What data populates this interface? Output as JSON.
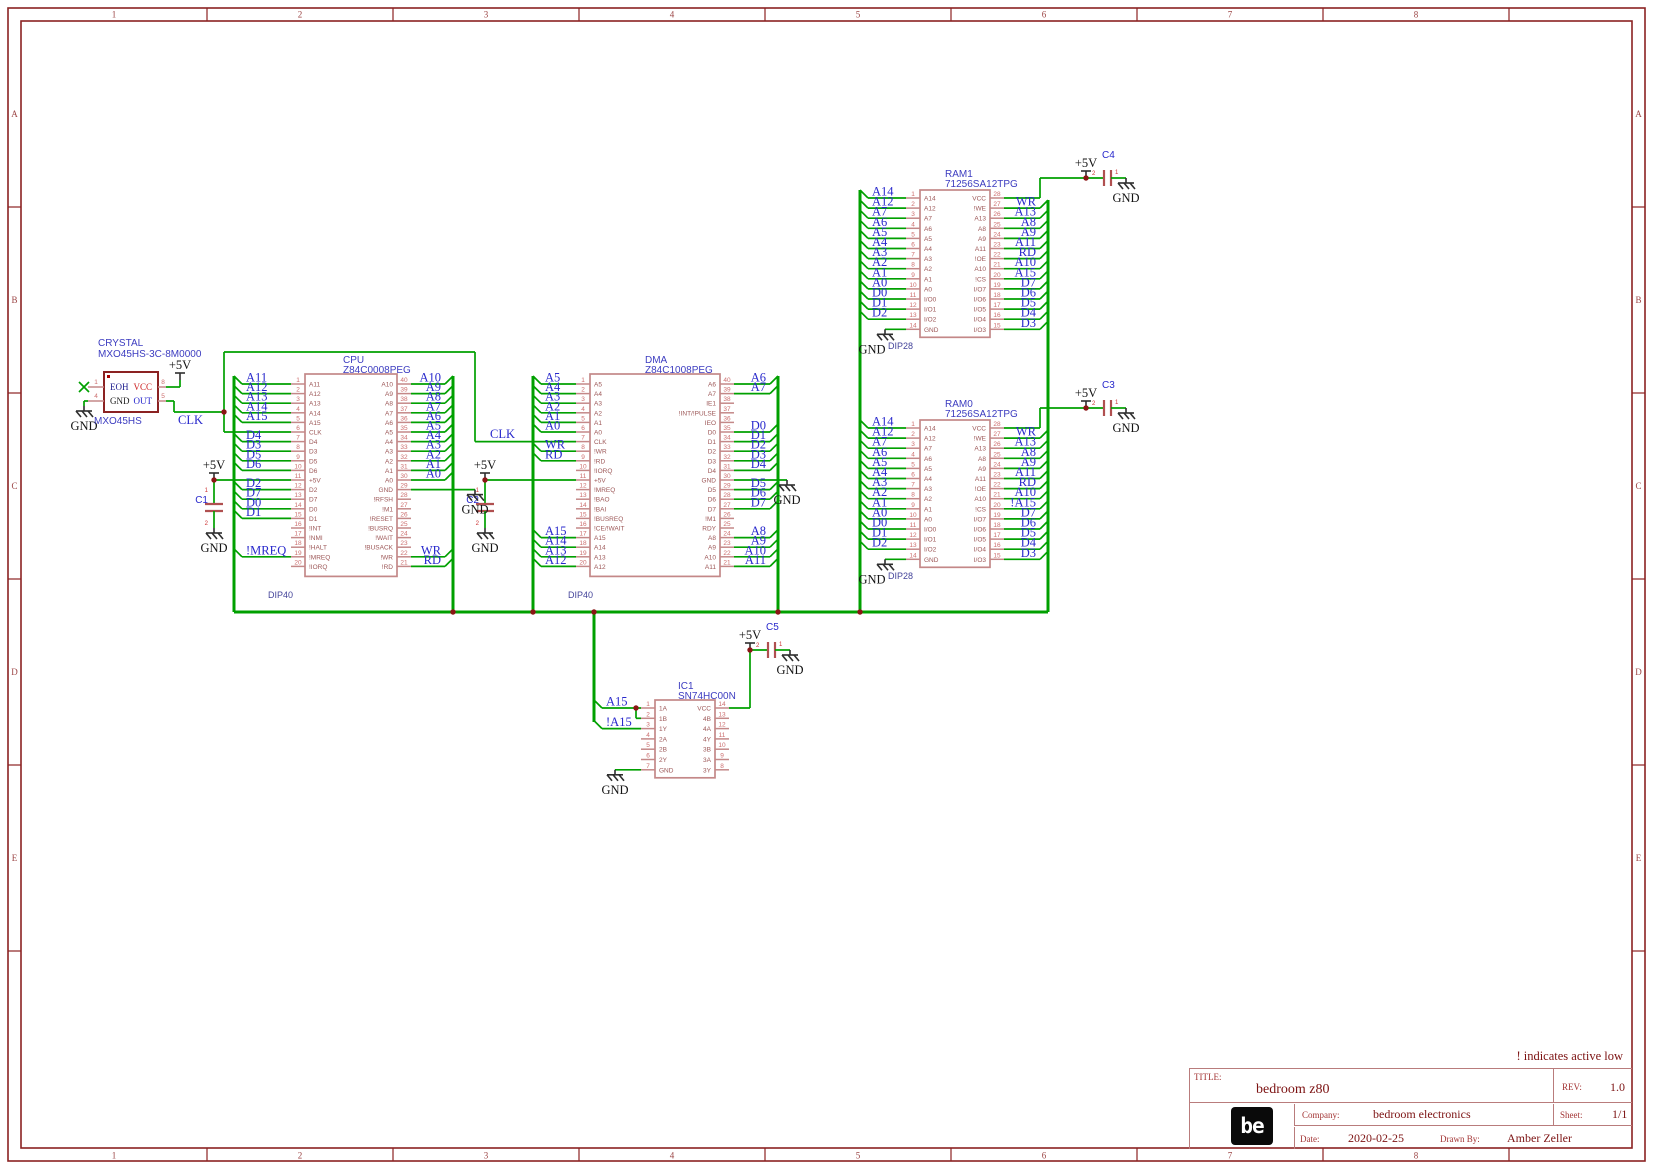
{
  "frame": {
    "columns": [
      "1",
      "2",
      "3",
      "4",
      "5",
      "6",
      "7",
      "8"
    ],
    "rows": [
      "A",
      "B",
      "C",
      "D",
      "E"
    ]
  },
  "note": "! indicates active low",
  "title_block": {
    "title_label": "TITLE:",
    "title": "bedroom z80",
    "rev_label": "REV:",
    "rev": "1.0",
    "company_label": "Company:",
    "company": "bedroom electronics",
    "sheet_label": "Sheet:",
    "sheet": "1/1",
    "date_label": "Date:",
    "date": "2020-02-25",
    "drawn_by_label": "Drawn By:",
    "drawn_by": "Amber Zeller",
    "logo": "be"
  },
  "power": {
    "v5": "+5V",
    "gnd": "GND",
    "clk": "CLK"
  },
  "crystal": {
    "title": "CRYSTAL",
    "part": "MXO45HS-3C-8M0000",
    "footprint": "MXO45HS",
    "pins": {
      "p1": {
        "num": "1",
        "name": "EOH"
      },
      "p4": {
        "num": "4",
        "name": "GND"
      },
      "p5": {
        "num": "5",
        "name": "OUT"
      },
      "p8": {
        "num": "8",
        "name": "VCC"
      }
    }
  },
  "capacitors": [
    {
      "ref": "C1"
    },
    {
      "ref": "C2"
    },
    {
      "ref": "C3"
    },
    {
      "ref": "C4"
    },
    {
      "ref": "C5"
    }
  ],
  "cap_pins": {
    "a": "1",
    "b": "2"
  },
  "chips": [
    {
      "id": "cpu",
      "ref": "CPU",
      "part": "Z84C0008PEG",
      "footprint": "DIP40",
      "left": [
        {
          "num": 1,
          "name": "A11",
          "net": "A11"
        },
        {
          "num": 2,
          "name": "A12",
          "net": "A12"
        },
        {
          "num": 3,
          "name": "A13",
          "net": "A13"
        },
        {
          "num": 4,
          "name": "A14",
          "net": "A14"
        },
        {
          "num": 5,
          "name": "A15",
          "net": "A15"
        },
        {
          "num": 6,
          "name": "CLK",
          "conn": "clk"
        },
        {
          "num": 7,
          "name": "D4",
          "net": "D4"
        },
        {
          "num": 8,
          "name": "D3",
          "net": "D3"
        },
        {
          "num": 9,
          "name": "D5",
          "net": "D5"
        },
        {
          "num": 10,
          "name": "D6",
          "net": "D6"
        },
        {
          "num": 11,
          "name": "+5V",
          "conn": "v5"
        },
        {
          "num": 12,
          "name": "D2",
          "net": "D2"
        },
        {
          "num": 13,
          "name": "D7",
          "net": "D7"
        },
        {
          "num": 14,
          "name": "D0",
          "net": "D0"
        },
        {
          "num": 15,
          "name": "D1",
          "net": "D1"
        },
        {
          "num": 16,
          "name": "!INT"
        },
        {
          "num": 17,
          "name": "!NMI"
        },
        {
          "num": 18,
          "name": "!HALT"
        },
        {
          "num": 19,
          "name": "!MREQ",
          "net": "!MREQ"
        },
        {
          "num": 20,
          "name": "!IORQ"
        }
      ],
      "right": [
        {
          "num": 40,
          "name": "A10",
          "net": "A10"
        },
        {
          "num": 39,
          "name": "A9",
          "net": "A9"
        },
        {
          "num": 38,
          "name": "A8",
          "net": "A8"
        },
        {
          "num": 37,
          "name": "A7",
          "net": "A7"
        },
        {
          "num": 36,
          "name": "A6",
          "net": "A6"
        },
        {
          "num": 35,
          "name": "A5",
          "net": "A5"
        },
        {
          "num": 34,
          "name": "A4",
          "net": "A4"
        },
        {
          "num": 33,
          "name": "A3",
          "net": "A3"
        },
        {
          "num": 32,
          "name": "A2",
          "net": "A2"
        },
        {
          "num": 31,
          "name": "A1",
          "net": "A1"
        },
        {
          "num": 30,
          "name": "A0",
          "net": "A0"
        },
        {
          "num": 29,
          "name": "GND",
          "conn": "gnd"
        },
        {
          "num": 28,
          "name": "!RFSH"
        },
        {
          "num": 27,
          "name": "!M1"
        },
        {
          "num": 26,
          "name": "!RESET"
        },
        {
          "num": 25,
          "name": "!BUSRQ"
        },
        {
          "num": 24,
          "name": "!WAIT"
        },
        {
          "num": 23,
          "name": "!BUSACK"
        },
        {
          "num": 22,
          "name": "!WR",
          "net": "WR"
        },
        {
          "num": 21,
          "name": "!RD",
          "net": "RD"
        }
      ]
    },
    {
      "id": "dma",
      "ref": "DMA",
      "part": "Z84C1008PEG",
      "footprint": "DIP40",
      "left": [
        {
          "num": 1,
          "name": "A5",
          "net": "A5"
        },
        {
          "num": 2,
          "name": "A4",
          "net": "A4"
        },
        {
          "num": 3,
          "name": "A3",
          "net": "A3"
        },
        {
          "num": 4,
          "name": "A2",
          "net": "A2"
        },
        {
          "num": 5,
          "name": "A1",
          "net": "A1"
        },
        {
          "num": 6,
          "name": "A0",
          "net": "A0"
        },
        {
          "num": 7,
          "name": "CLK",
          "conn": "clk"
        },
        {
          "num": 8,
          "name": "!WR",
          "net": "WR"
        },
        {
          "num": 9,
          "name": "!RD",
          "net": "RD"
        },
        {
          "num": 10,
          "name": "!IORQ"
        },
        {
          "num": 11,
          "name": "+5V",
          "conn": "v5"
        },
        {
          "num": 12,
          "name": "!MREQ"
        },
        {
          "num": 13,
          "name": "!BAO"
        },
        {
          "num": 14,
          "name": "!BAI"
        },
        {
          "num": 15,
          "name": "!BUSREQ"
        },
        {
          "num": 16,
          "name": "!CE/!WAIT"
        },
        {
          "num": 17,
          "name": "A15",
          "net": "A15"
        },
        {
          "num": 18,
          "name": "A14",
          "net": "A14"
        },
        {
          "num": 19,
          "name": "A13",
          "net": "A13"
        },
        {
          "num": 20,
          "name": "A12",
          "net": "A12"
        }
      ],
      "right": [
        {
          "num": 40,
          "name": "A6",
          "net": "A6"
        },
        {
          "num": 39,
          "name": "A7",
          "net": "A7"
        },
        {
          "num": 38,
          "name": "IE1"
        },
        {
          "num": 37,
          "name": "!INT/!PULSE"
        },
        {
          "num": 36,
          "name": "IEO"
        },
        {
          "num": 35,
          "name": "D0",
          "net": "D0"
        },
        {
          "num": 34,
          "name": "D1",
          "net": "D1"
        },
        {
          "num": 33,
          "name": "D2",
          "net": "D2"
        },
        {
          "num": 32,
          "name": "D3",
          "net": "D3"
        },
        {
          "num": 31,
          "name": "D4",
          "net": "D4"
        },
        {
          "num": 30,
          "name": "GND",
          "conn": "gnd"
        },
        {
          "num": 29,
          "name": "D5",
          "net": "D5"
        },
        {
          "num": 28,
          "name": "D6",
          "net": "D6"
        },
        {
          "num": 27,
          "name": "D7",
          "net": "D7"
        },
        {
          "num": 26,
          "name": "!M1"
        },
        {
          "num": 25,
          "name": "RDY"
        },
        {
          "num": 24,
          "name": "A8",
          "net": "A8"
        },
        {
          "num": 23,
          "name": "A9",
          "net": "A9"
        },
        {
          "num": 22,
          "name": "A10",
          "net": "A10"
        },
        {
          "num": 21,
          "name": "A11",
          "net": "A11"
        }
      ]
    },
    {
      "id": "ram1",
      "ref": "RAM1",
      "part": "71256SA12TPG",
      "footprint": "DIP28",
      "left": [
        {
          "num": 1,
          "name": "A14",
          "net": "A14"
        },
        {
          "num": 2,
          "name": "A12",
          "net": "A12"
        },
        {
          "num": 3,
          "name": "A7",
          "net": "A7"
        },
        {
          "num": 4,
          "name": "A6",
          "net": "A6"
        },
        {
          "num": 5,
          "name": "A5",
          "net": "A5"
        },
        {
          "num": 6,
          "name": "A4",
          "net": "A4"
        },
        {
          "num": 7,
          "name": "A3",
          "net": "A3"
        },
        {
          "num": 8,
          "name": "A2",
          "net": "A2"
        },
        {
          "num": 9,
          "name": "A1",
          "net": "A1"
        },
        {
          "num": 10,
          "name": "A0",
          "net": "A0"
        },
        {
          "num": 11,
          "name": "I/O0",
          "net": "D0"
        },
        {
          "num": 12,
          "name": "I/O1",
          "net": "D1"
        },
        {
          "num": 13,
          "name": "I/O2",
          "net": "D2"
        },
        {
          "num": 14,
          "name": "GND",
          "conn": "gnd"
        }
      ],
      "right": [
        {
          "num": 28,
          "name": "VCC",
          "conn": "v5"
        },
        {
          "num": 27,
          "name": "!WE",
          "net": "WR"
        },
        {
          "num": 26,
          "name": "A13",
          "net": "A13"
        },
        {
          "num": 25,
          "name": "A8",
          "net": "A8"
        },
        {
          "num": 24,
          "name": "A9",
          "net": "A9"
        },
        {
          "num": 23,
          "name": "A11",
          "net": "A11"
        },
        {
          "num": 22,
          "name": "!OE",
          "net": "RD"
        },
        {
          "num": 21,
          "name": "A10",
          "net": "A10"
        },
        {
          "num": 20,
          "name": "!CS",
          "net": "A15"
        },
        {
          "num": 19,
          "name": "I/O7",
          "net": "D7"
        },
        {
          "num": 18,
          "name": "I/O6",
          "net": "D6"
        },
        {
          "num": 17,
          "name": "I/O5",
          "net": "D5"
        },
        {
          "num": 16,
          "name": "I/O4",
          "net": "D4"
        },
        {
          "num": 15,
          "name": "I/O3",
          "net": "D3"
        }
      ]
    },
    {
      "id": "ram0",
      "ref": "RAM0",
      "part": "71256SA12TPG",
      "footprint": "DIP28",
      "left": [
        {
          "num": 1,
          "name": "A14",
          "net": "A14"
        },
        {
          "num": 2,
          "name": "A12",
          "net": "A12"
        },
        {
          "num": 3,
          "name": "A7",
          "net": "A7"
        },
        {
          "num": 4,
          "name": "A6",
          "net": "A6"
        },
        {
          "num": 5,
          "name": "A5",
          "net": "A5"
        },
        {
          "num": 6,
          "name": "A4",
          "net": "A4"
        },
        {
          "num": 7,
          "name": "A3",
          "net": "A3"
        },
        {
          "num": 8,
          "name": "A2",
          "net": "A2"
        },
        {
          "num": 9,
          "name": "A1",
          "net": "A1"
        },
        {
          "num": 10,
          "name": "A0",
          "net": "A0"
        },
        {
          "num": 11,
          "name": "I/O0",
          "net": "D0"
        },
        {
          "num": 12,
          "name": "I/O1",
          "net": "D1"
        },
        {
          "num": 13,
          "name": "I/O2",
          "net": "D2"
        },
        {
          "num": 14,
          "name": "GND",
          "conn": "gnd"
        }
      ],
      "right": [
        {
          "num": 28,
          "name": "VCC",
          "conn": "v5"
        },
        {
          "num": 27,
          "name": "!WE",
          "net": "WR"
        },
        {
          "num": 26,
          "name": "A13",
          "net": "A13"
        },
        {
          "num": 25,
          "name": "A8",
          "net": "A8"
        },
        {
          "num": 24,
          "name": "A9",
          "net": "A9"
        },
        {
          "num": 23,
          "name": "A11",
          "net": "A11"
        },
        {
          "num": 22,
          "name": "!OE",
          "net": "RD"
        },
        {
          "num": 21,
          "name": "A10",
          "net": "A10"
        },
        {
          "num": 20,
          "name": "!CS",
          "net": "!A15"
        },
        {
          "num": 19,
          "name": "I/O7",
          "net": "D7"
        },
        {
          "num": 18,
          "name": "I/O6",
          "net": "D6"
        },
        {
          "num": 17,
          "name": "I/O5",
          "net": "D5"
        },
        {
          "num": 16,
          "name": "I/O4",
          "net": "D4"
        },
        {
          "num": 15,
          "name": "I/O3",
          "net": "D3"
        }
      ]
    },
    {
      "id": "ic1",
      "ref": "IC1",
      "part": "SN74HC00N",
      "footprint": "",
      "left": [
        {
          "num": 1,
          "name": "1A",
          "net": "A15"
        },
        {
          "num": 2,
          "name": "1B",
          "conn": "tie"
        },
        {
          "num": 3,
          "name": "1Y",
          "net": "!A15"
        },
        {
          "num": 4,
          "name": "2A"
        },
        {
          "num": 5,
          "name": "2B"
        },
        {
          "num": 6,
          "name": "2Y"
        },
        {
          "num": 7,
          "name": "GND",
          "conn": "gnd"
        }
      ],
      "right": [
        {
          "num": 14,
          "name": "VCC",
          "conn": "v5"
        },
        {
          "num": 13,
          "name": "4B"
        },
        {
          "num": 12,
          "name": "4A"
        },
        {
          "num": 11,
          "name": "4Y"
        },
        {
          "num": 10,
          "name": "3B"
        },
        {
          "num": 9,
          "name": "3A"
        },
        {
          "num": 8,
          "name": "3Y"
        }
      ]
    }
  ]
}
